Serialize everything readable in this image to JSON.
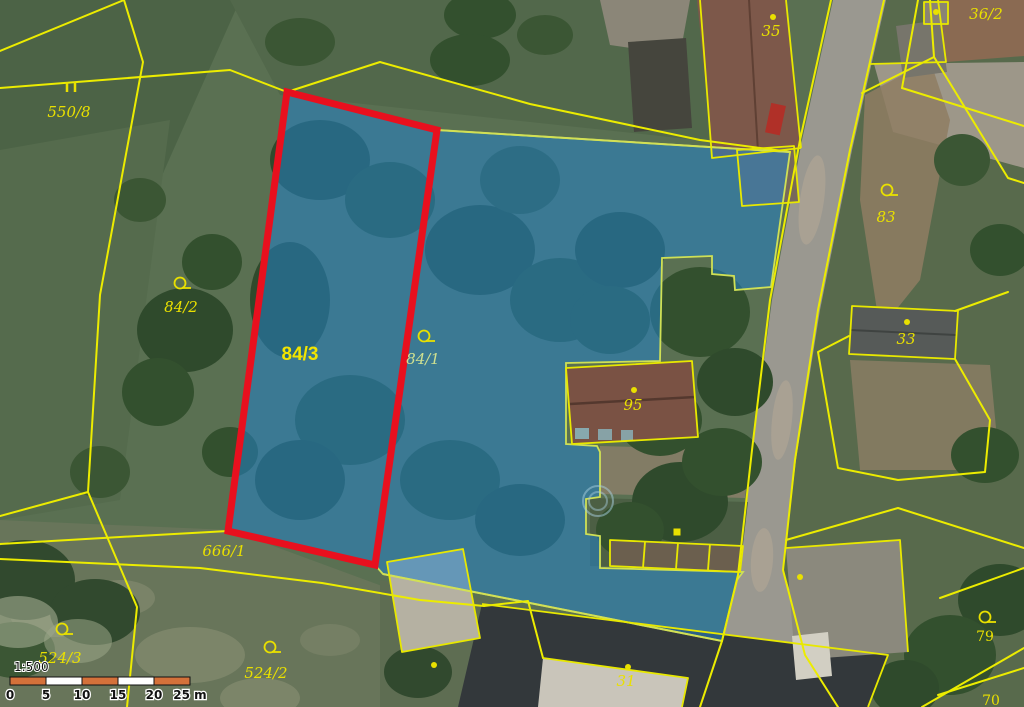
{
  "map": {
    "selected_parcel_label": "84/3",
    "highlighted_area_labels": [
      "84/3",
      "84/1"
    ],
    "colors": {
      "parcel_line": "#ecec00",
      "selected_outline": "#e8101e",
      "highlight_fill": "#2382c8",
      "label_text": "#e9e000"
    },
    "labels": [
      {
        "id": "550-8",
        "text": "550/8",
        "x": 69,
        "y": 117,
        "style": "italic",
        "symbol": "meadow",
        "sx": 71,
        "sy": 88
      },
      {
        "id": "84-2",
        "text": "84/2",
        "x": 181,
        "y": 312,
        "style": "italic",
        "symbol": "tree",
        "sx": 180,
        "sy": 283
      },
      {
        "id": "84-3",
        "text": "84/3",
        "x": 300,
        "y": 360,
        "style": "bold",
        "symbol": "none"
      },
      {
        "id": "84-1",
        "text": "84/1",
        "x": 423,
        "y": 364,
        "style": "italic",
        "muted": true,
        "symbol": "tree",
        "sx": 424,
        "sy": 336
      },
      {
        "id": "95",
        "text": "95",
        "x": 633,
        "y": 410,
        "style": "italic",
        "symbol": "dot",
        "sx": 634,
        "sy": 390
      },
      {
        "id": "666-1",
        "text": "666/1",
        "x": 224,
        "y": 556,
        "style": "italic",
        "symbol": "none"
      },
      {
        "id": "524-3",
        "text": "524/3",
        "x": 60,
        "y": 663,
        "style": "italic",
        "symbol": "tree",
        "sx": 62,
        "sy": 629
      },
      {
        "id": "524-2",
        "text": "524/2",
        "x": 266,
        "y": 678,
        "style": "italic",
        "symbol": "tree",
        "sx": 270,
        "sy": 647
      },
      {
        "id": "36-2",
        "text": "36/2",
        "x": 986,
        "y": 19,
        "style": "italic",
        "symbol": "none"
      },
      {
        "id": "35",
        "text": "35",
        "x": 771,
        "y": 36,
        "style": "italic",
        "symbol": "dot",
        "sx": 773,
        "sy": 17
      },
      {
        "id": "83",
        "text": "83",
        "x": 886,
        "y": 222,
        "style": "italic",
        "symbol": "tree",
        "sx": 887,
        "sy": 190
      },
      {
        "id": "33",
        "text": "33",
        "x": 906,
        "y": 344,
        "style": "italic",
        "symbol": "dot",
        "sx": 907,
        "sy": 322
      },
      {
        "id": "79",
        "text": "79",
        "x": 985,
        "y": 641,
        "style": "plain",
        "symbol": "tree",
        "sx": 985,
        "sy": 617
      },
      {
        "id": "70",
        "text": "70",
        "x": 991,
        "y": 705,
        "style": "plain",
        "symbol": "none"
      },
      {
        "id": "31",
        "text": "31",
        "x": 626,
        "y": 686,
        "style": "italic",
        "symbol": "dot",
        "sx": 628,
        "sy": 667
      }
    ],
    "markers": [
      {
        "type": "dot",
        "x": 434,
        "y": 665
      },
      {
        "type": "dot",
        "x": 936,
        "y": 12
      },
      {
        "type": "dot",
        "x": 800,
        "y": 577
      },
      {
        "type": "square",
        "x": 677,
        "y": 532
      }
    ]
  },
  "scalebar": {
    "ratio": "1:500",
    "tick_labels": [
      "0",
      "5",
      "10",
      "15",
      "20",
      "25 m"
    ],
    "segment_colors": [
      "#d4713a",
      "#ffffff",
      "#d4713a",
      "#ffffff",
      "#d4713a"
    ],
    "x0": 10,
    "y": 677,
    "segment_width": 36,
    "height": 8
  }
}
